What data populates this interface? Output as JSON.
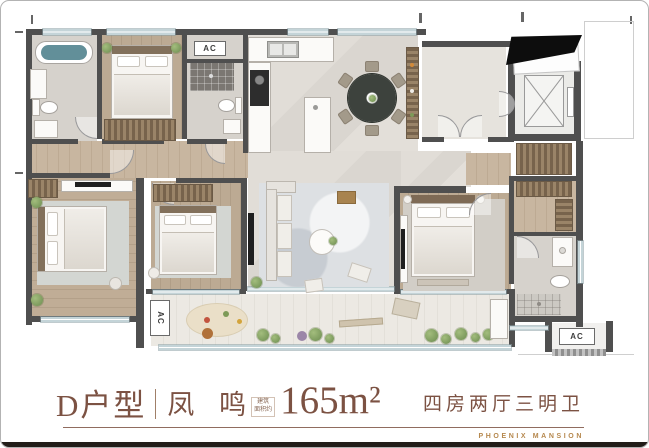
{
  "card": {
    "background": "#ffffff",
    "border_color": "#b3b3b3",
    "bottom_edge_color": "#221d19"
  },
  "plan": {
    "labels": {
      "ac_closet": "AC",
      "ac_balcony": "AC",
      "ac_platform": "AC"
    },
    "colors": {
      "wall": "#4f4f4f",
      "wood_floor": "#b9a68f",
      "marble_floor": "#dedad4",
      "balcony_floor": "#e9e6e0",
      "window": "#c4d4d8",
      "greenery": "#6c8c50",
      "tub_water": "#628f99"
    }
  },
  "caption": {
    "unit_label": "D户型",
    "series_name": "凤 鸣",
    "area_note_line1": "建筑",
    "area_note_line2": "面积约",
    "area_value": "165m²",
    "layout_desc": "四房两厅三明卫",
    "brand": "PHOENIX MANSION",
    "text_color": "#7c5243",
    "gold_color": "#b6884e"
  }
}
